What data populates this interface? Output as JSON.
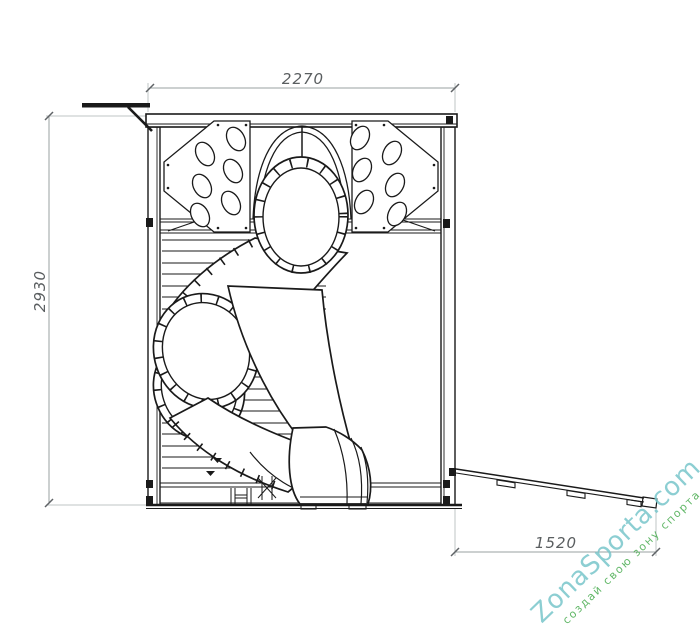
{
  "diagram": {
    "dimensions": {
      "overall_width": "2270",
      "overall_height": "2930",
      "ramp_length": "1520"
    },
    "line_color": "#1a1a1a",
    "dimension_line_color": "#9aa0a2",
    "dimension_text_color": "#5a5e60",
    "background": "#ffffff"
  },
  "watermark": {
    "brand": "ZonaSporta.com",
    "tagline": "создай свою зону спорта",
    "brand_color": "#79c6cb",
    "tagline_color": "#46ab4d"
  }
}
